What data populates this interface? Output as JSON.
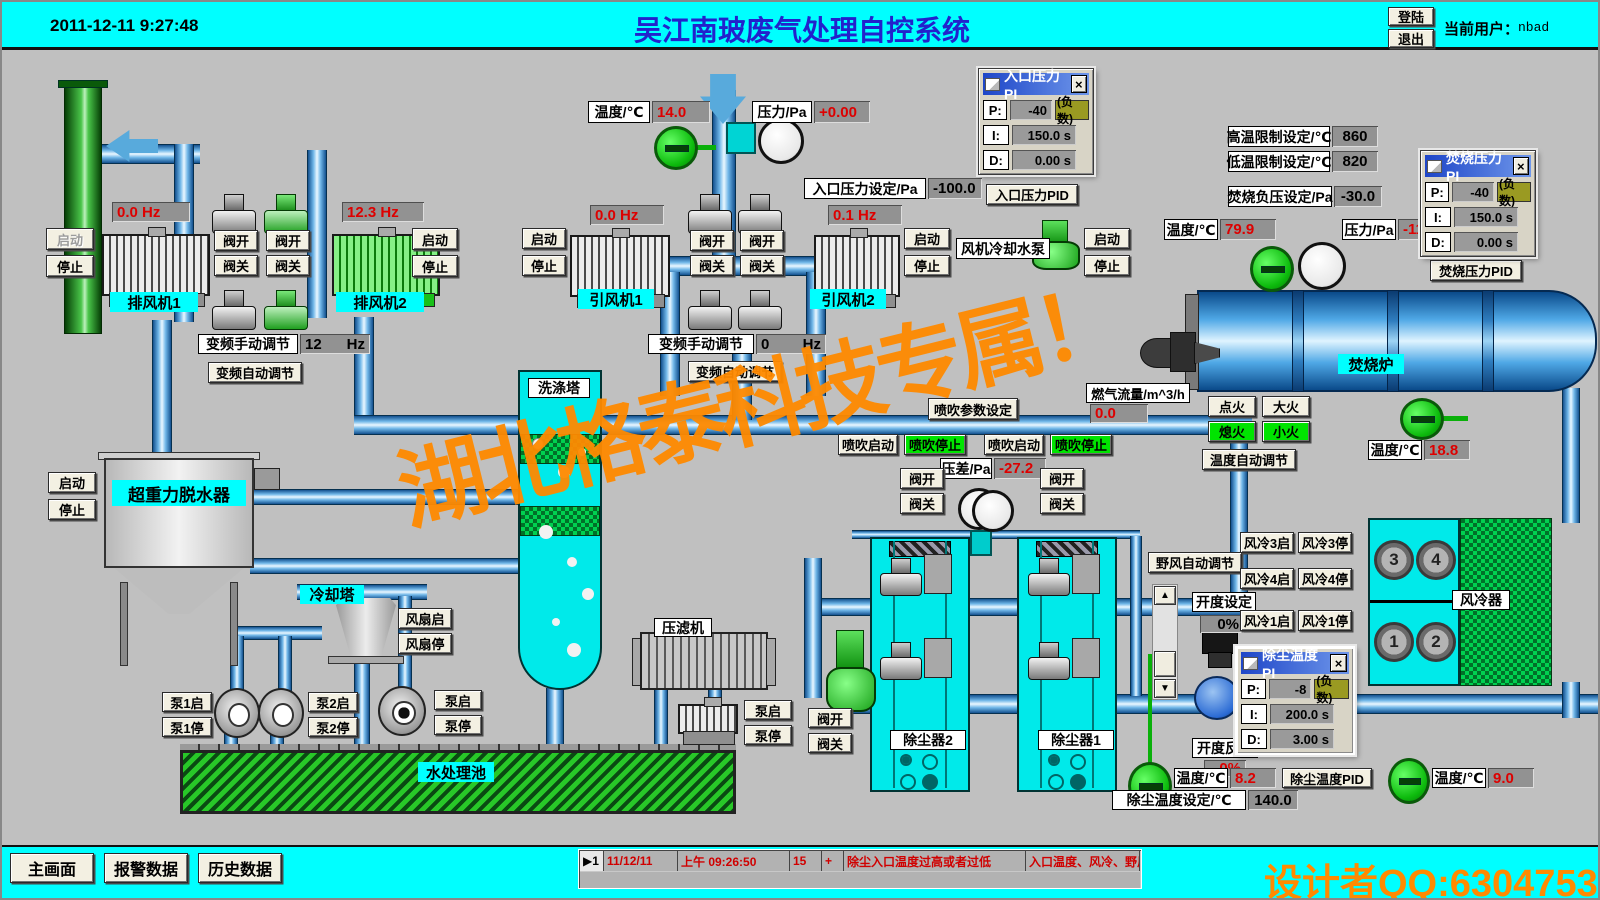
{
  "colors": {
    "cyan": "#00ffff",
    "alarm_red": "#dd0000",
    "watermark_orange": "#ff8a00",
    "title_blue": "#2222cc",
    "pipe_blue": "#4fa8e6",
    "active_green": "#00e400"
  },
  "icons": {
    "up": "▲",
    "down": "▼",
    "close": "×",
    "marker": "▶"
  },
  "common": {
    "start": "启动",
    "stop": "停止",
    "valve_open": "阀开",
    "valve_close": "阀关",
    "temp_label": "温度/℃",
    "hz": "Hz"
  },
  "header": {
    "datetime": "2011-12-11 9:27:48",
    "title": "吴江南玻废气处理自控系统",
    "login": "登陆",
    "logout": "退出",
    "user_label": "当前用户：",
    "user": "nbad"
  },
  "watermark": {
    "diagonal": "湖北格泰科技专属！",
    "designer": "设计者QQ:6304753"
  },
  "exhaust": {
    "fan1": "排风机1",
    "fan1_hz": "0.0 Hz",
    "fan2": "排风机2",
    "fan2_hz": "12.3 Hz",
    "vfd_manual": "变频手动调节",
    "vfd_value": "12",
    "vfd_auto": "变频自动调节"
  },
  "inlet": {
    "temp": "14.0",
    "press_label": "压力/Pa",
    "press": "+0.00",
    "set_label": "入口压力设定/Pa",
    "set": "-100.0",
    "fan1": "引风机1",
    "fan1_hz": "0.0 Hz",
    "fan2": "引风机2",
    "fan2_hz": "0.1 Hz",
    "vfd_manual": "变频手动调节",
    "vfd_value": "0",
    "vfd_auto": "变频自动调节"
  },
  "pid_inlet": {
    "title": "入口压力PI",
    "p": "P:",
    "p_val": "-40",
    "neg": "(负数)",
    "i": "I:",
    "i_val": "150.0 s",
    "d": "D:",
    "d_val": "0.00 s",
    "button": "入口压力PID"
  },
  "pid_burn": {
    "title": "焚烧压力PI",
    "p": "P:",
    "p_val": "-40",
    "neg": "(负数)",
    "i": "I:",
    "i_val": "150.0 s",
    "d": "D:",
    "d_val": "0.00 s",
    "button": "焚烧压力PID"
  },
  "pid_dust": {
    "title": "除尘温度PI",
    "p": "P:",
    "p_val": "-8",
    "neg": "(负数)",
    "i": "I:",
    "i_val": "200.0 s",
    "d": "D:",
    "d_val": "3.00 s",
    "button": "除尘温度PID"
  },
  "limits": {
    "high_label": "高温限制设定/℃",
    "high": "860",
    "low_label": "低温限制设定/℃",
    "low": "820",
    "negp_label": "焚烧负压设定/Pa",
    "negp": "-30.0",
    "temp": "79.9",
    "press_label": "压力/Pa",
    "press": "-112.6"
  },
  "coolpump": {
    "label": "风机冷却水泵"
  },
  "furnace": {
    "label": "焚烧炉",
    "gas_label": "燃气流量/m^3/h",
    "gas": "0.0",
    "ignite": "点火",
    "big_fire": "大火",
    "off_fire": "熄火",
    "small_fire": "小火",
    "auto": "温度自动调节",
    "temp": "18.8"
  },
  "spray": {
    "param": "喷吹参数设定",
    "start": "喷吹启动",
    "stop": "喷吹停止",
    "dp_label": "压差/Pa",
    "dp": "-27.2"
  },
  "dehydrator": {
    "label": "超重力脱水器"
  },
  "ctower": {
    "label": "冷却塔",
    "fan_on": "风扇启",
    "fan_off": "风扇停"
  },
  "pumps": {
    "p1_on": "泵1启",
    "p1_off": "泵1停",
    "p2_on": "泵2启",
    "p2_off": "泵2停",
    "p_on": "泵启",
    "p_off": "泵停"
  },
  "pool": {
    "label": "水处理池"
  },
  "scrubber": {
    "label": "洗涤塔"
  },
  "fpress": {
    "label": "压滤机",
    "p_on": "泵启",
    "p_off": "泵停"
  },
  "dust": {
    "c1": "除尘器1",
    "c2": "除尘器2",
    "wild": "野风自动调节",
    "open_set_label": "开度设定",
    "open_set": "0%",
    "open_fb_label": "开度反馈",
    "open_fb": "0%",
    "t_in": "8.2",
    "set_label": "除尘温度设定/℃",
    "set": "140.0",
    "t_out": "9.0"
  },
  "cooler": {
    "label": "风冷器",
    "f1": "1",
    "f2": "2",
    "f3": "3",
    "f4": "4",
    "b3on": "风冷3启",
    "b3off": "风冷3停",
    "b4on": "风冷4启",
    "b4off": "风冷4停",
    "b1on": "风冷1启",
    "b1off": "风冷1停"
  },
  "footer": {
    "main": "主画面",
    "alarm": "报警数据",
    "history": "历史数据",
    "row": {
      "no": "1",
      "date": "11/12/11",
      "time": "上午 09:26:50",
      "code": "15",
      "plus": "+",
      "msg": "除尘入口温度过高或者过低",
      "vars": "入口温度、风冷、野风"
    }
  }
}
